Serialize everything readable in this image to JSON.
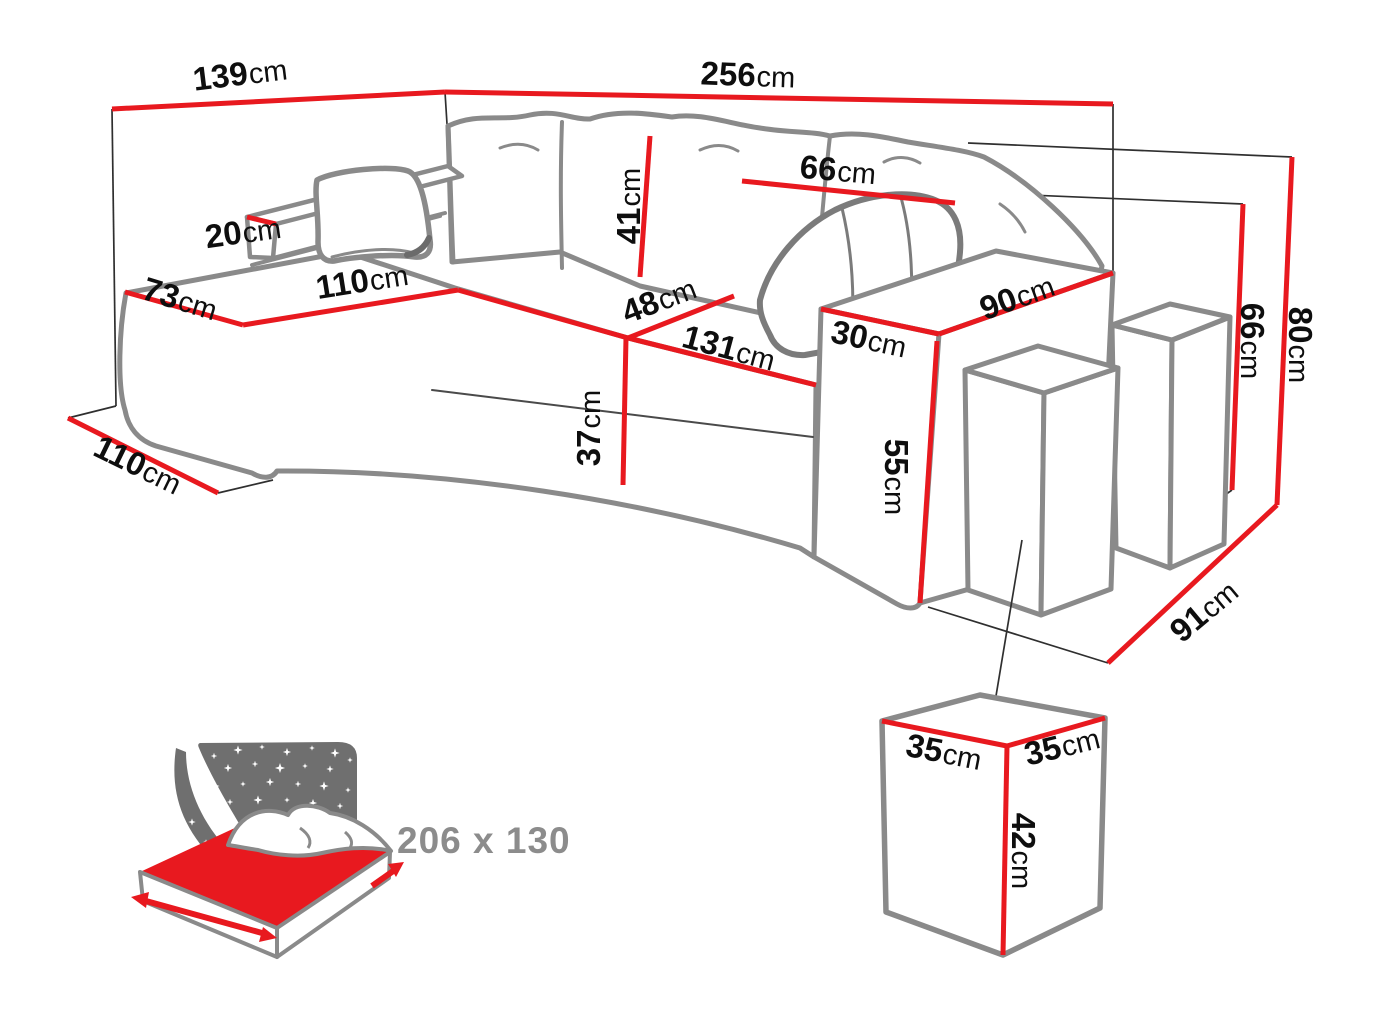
{
  "diagram": {
    "type": "corner-sofa dimension drawing",
    "unit": "cm",
    "colors": {
      "dimension_red": "#e8191f",
      "drawing_gray": "#8a8a8a",
      "wireframe_black": "#2f2f2f",
      "label_black": "#0e0e0e",
      "icon_gray": "#6f6f6f",
      "bed_text_gray": "#8c8c8c",
      "mattress_red": "#e8191f"
    },
    "icons": [
      "corner-sofa-line-drawing",
      "stacked-poufs-drawing",
      "pouf-cube-detail-drawing",
      "sleep-function-bed-icon",
      "night-sky-stars-icon",
      "red-dimension-arrows-icon"
    ]
  },
  "dimensions": {
    "back_width_left": {
      "value": "139",
      "unit": "cm"
    },
    "back_width_top": {
      "value": "256",
      "unit": "cm"
    },
    "back_cushion_width": {
      "value": "66",
      "unit": "cm"
    },
    "back_cushion_height": {
      "value": "41",
      "unit": "cm"
    },
    "side_rest_width": {
      "value": "20",
      "unit": "cm"
    },
    "chaise_front_width": {
      "value": "73",
      "unit": "cm"
    },
    "chaise_seat_length": {
      "value": "110",
      "unit": "cm"
    },
    "corner_seat_width": {
      "value": "48",
      "unit": "cm"
    },
    "main_seat_width": {
      "value": "131",
      "unit": "cm"
    },
    "armrest_width": {
      "value": "30",
      "unit": "cm"
    },
    "armrest_depth": {
      "value": "90",
      "unit": "cm"
    },
    "seat_height": {
      "value": "37",
      "unit": "cm"
    },
    "armrest_height": {
      "value": "55",
      "unit": "cm"
    },
    "backrest_height": {
      "value": "66",
      "unit": "cm"
    },
    "total_height": {
      "value": "80",
      "unit": "cm"
    },
    "chaise_total_depth": {
      "value": "110",
      "unit": "cm"
    },
    "sofa_depth": {
      "value": "91",
      "unit": "cm"
    },
    "pouf_width": {
      "value": "35",
      "unit": "cm"
    },
    "pouf_depth": {
      "value": "35",
      "unit": "cm"
    },
    "pouf_height": {
      "value": "42",
      "unit": "cm"
    }
  },
  "sleeping_area": {
    "label": "206 x 130"
  }
}
